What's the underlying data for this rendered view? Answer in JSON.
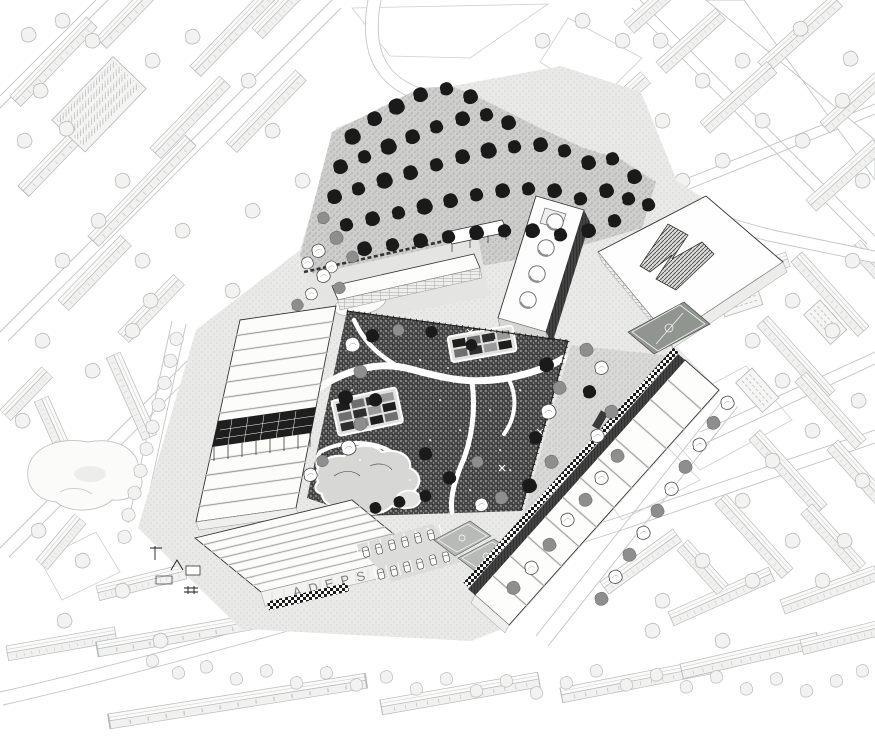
{
  "meta": {
    "title": "Black-and-white axonometric masterplan illustration",
    "description": "Bird's-eye axonometric drawing of an urban block: dark central park with winding paths framed by long white workshop buildings, a tree grove, a perforated slab, sports facilities and light-gray city fabric all around."
  },
  "colors": {
    "paper": "#ffffff",
    "ink": "#1a1a1a",
    "context_line": "#b7babc",
    "context_fill": "#f2f2f1",
    "park_fill": "#474747",
    "ground_light": "#e9e9e8",
    "ground_mid": "#cbcbca",
    "tree_dark": "#1a1a1a",
    "tree_gray": "#8e8e8e",
    "pitch_fill": "#90958f",
    "court_fill": "#b7bab7",
    "sign": "#7d7d7d"
  },
  "site": {
    "sign_text": "ADEPS"
  },
  "scene": {
    "slab_circles": [
      [
        528,
        300
      ],
      [
        537,
        274
      ],
      [
        546,
        248
      ],
      [
        555,
        222
      ]
    ],
    "beds": [
      {
        "x": 336,
        "y": 404,
        "rot": -12,
        "rows": 3,
        "cols": 4
      },
      {
        "x": 452,
        "y": 340,
        "rot": -10,
        "rows": 2,
        "cols": 4
      }
    ],
    "trees": {
      "grove_dark": [
        [
          352,
          138,
          1.1
        ],
        [
          374,
          120,
          1.0
        ],
        [
          396,
          108,
          1.1
        ],
        [
          420,
          96,
          1.0
        ],
        [
          446,
          90,
          0.9
        ],
        [
          470,
          98,
          1.0
        ],
        [
          340,
          168,
          1.0
        ],
        [
          364,
          158,
          0.9
        ],
        [
          388,
          148,
          1.1
        ],
        [
          412,
          138,
          1.0
        ],
        [
          436,
          128,
          0.9
        ],
        [
          462,
          120,
          1.0
        ],
        [
          486,
          116,
          0.9
        ],
        [
          508,
          124,
          1.0
        ],
        [
          334,
          198,
          1.0
        ],
        [
          358,
          190,
          0.9
        ],
        [
          384,
          182,
          1.1
        ],
        [
          410,
          174,
          1.0
        ],
        [
          436,
          166,
          0.9
        ],
        [
          462,
          158,
          1.0
        ],
        [
          488,
          152,
          1.1
        ],
        [
          514,
          148,
          0.9
        ],
        [
          540,
          146,
          1.0
        ],
        [
          564,
          152,
          0.9
        ],
        [
          588,
          164,
          1.0
        ],
        [
          346,
          226,
          0.9
        ],
        [
          372,
          220,
          1.0
        ],
        [
          398,
          214,
          0.9
        ],
        [
          424,
          208,
          1.1
        ],
        [
          450,
          202,
          1.0
        ],
        [
          476,
          196,
          0.9
        ],
        [
          502,
          192,
          1.0
        ],
        [
          528,
          190,
          0.9
        ],
        [
          554,
          192,
          1.0
        ],
        [
          580,
          200,
          0.9
        ],
        [
          606,
          192,
          1.0
        ],
        [
          628,
          200,
          0.9
        ],
        [
          364,
          250,
          1.0
        ],
        [
          392,
          246,
          0.9
        ],
        [
          420,
          242,
          1.0
        ],
        [
          448,
          238,
          0.9
        ],
        [
          476,
          234,
          1.0
        ],
        [
          504,
          232,
          0.9
        ],
        [
          532,
          232,
          1.0
        ],
        [
          560,
          236,
          0.9
        ],
        [
          588,
          232,
          1.0
        ],
        [
          614,
          222,
          0.9
        ],
        [
          612,
          160,
          0.9
        ],
        [
          634,
          178,
          1.0
        ],
        [
          648,
          206,
          0.9
        ]
      ],
      "grove_gray": [
        [
          336,
          239,
          0.9
        ],
        [
          323,
          219,
          0.8
        ],
        [
          352,
          258,
          0.8
        ]
      ],
      "grove_light": [
        [
          318,
          252,
          0.9
        ],
        [
          307,
          264,
          0.8
        ],
        [
          331,
          268,
          0.8
        ]
      ],
      "park": [
        [
          352,
          346,
          "w",
          1.0
        ],
        [
          360,
          373,
          "g",
          0.9
        ],
        [
          345,
          399,
          "d",
          1.0
        ],
        [
          360,
          425,
          "g",
          0.9
        ],
        [
          348,
          449,
          "w",
          1.0
        ],
        [
          375,
          401,
          "d",
          0.9
        ],
        [
          322,
          462,
          "g",
          0.8
        ],
        [
          310,
          476,
          "w",
          0.9
        ],
        [
          372,
          337,
          "d",
          0.9
        ],
        [
          398,
          331,
          "g",
          0.8
        ],
        [
          546,
          366,
          "d",
          1.0
        ],
        [
          559,
          389,
          "g",
          0.9
        ],
        [
          548,
          413,
          "w",
          1.0
        ],
        [
          535,
          439,
          "d",
          0.9
        ],
        [
          551,
          463,
          "g",
          0.9
        ],
        [
          529,
          487,
          "d",
          1.0
        ],
        [
          501,
          499,
          "g",
          0.9
        ],
        [
          481,
          506,
          "w",
          0.9
        ],
        [
          431,
          333,
          "d",
          0.8
        ],
        [
          471,
          346,
          "d",
          0.8
        ],
        [
          425,
          455,
          "d",
          0.9
        ],
        [
          477,
          463,
          "g",
          0.8
        ],
        [
          449,
          479,
          "d",
          0.9
        ],
        [
          375,
          509,
          "d",
          0.8
        ],
        [
          399,
          503,
          "d",
          0.8
        ],
        [
          425,
          497,
          "d",
          0.8
        ]
      ],
      "ne_strip": [
        [
          586,
          351,
          "g",
          0.9
        ],
        [
          601,
          369,
          "w",
          0.9
        ],
        [
          589,
          393,
          "d",
          0.9
        ],
        [
          611,
          413,
          "g",
          0.9
        ],
        [
          597,
          437,
          "w",
          0.9
        ],
        [
          617,
          457,
          "g",
          0.9
        ],
        [
          601,
          479,
          "w",
          0.9
        ],
        [
          585,
          501,
          "g",
          0.9
        ],
        [
          567,
          521,
          "w",
          0.9
        ],
        [
          549,
          546,
          "g",
          0.9
        ],
        [
          531,
          569,
          "w",
          0.9
        ],
        [
          513,
          589,
          "g",
          0.9
        ]
      ],
      "street_right": [
        [
          727,
          404,
          "w",
          0.9
        ],
        [
          713,
          424,
          "g",
          0.9
        ],
        [
          699,
          446,
          "w",
          0.9
        ],
        [
          685,
          468,
          "g",
          0.9
        ],
        [
          671,
          490,
          "w",
          0.9
        ],
        [
          657,
          512,
          "g",
          0.9
        ],
        [
          643,
          534,
          "w",
          0.9
        ],
        [
          629,
          556,
          "g",
          0.9
        ],
        [
          615,
          578,
          "w",
          0.9
        ],
        [
          601,
          600,
          "g",
          0.9
        ]
      ],
      "west_street": [
        [
          176,
          340
        ],
        [
          170,
          362
        ],
        [
          164,
          384
        ],
        [
          158,
          406
        ],
        [
          152,
          428
        ],
        [
          146,
          450
        ],
        [
          140,
          472
        ],
        [
          134,
          494
        ],
        [
          128,
          516
        ],
        [
          124,
          538
        ]
      ],
      "nw_cluster": [
        [
          323,
          277,
          "w",
          0.9
        ],
        [
          339,
          289,
          "g",
          0.8
        ],
        [
          311,
          295,
          "w",
          0.8
        ],
        [
          297,
          306,
          "g",
          0.8
        ]
      ],
      "context": [
        [
          28,
          36
        ],
        [
          62,
          22
        ],
        [
          92,
          42
        ],
        [
          40,
          92
        ],
        [
          24,
          142
        ],
        [
          66,
          130
        ],
        [
          152,
          62
        ],
        [
          192,
          38
        ],
        [
          248,
          82
        ],
        [
          272,
          132
        ],
        [
          122,
          182
        ],
        [
          98,
          222
        ],
        [
          62,
          262
        ],
        [
          142,
          262
        ],
        [
          182,
          232
        ],
        [
          252,
          212
        ],
        [
          302,
          182
        ],
        [
          232,
          292
        ],
        [
          132,
          332
        ],
        [
          92,
          372
        ],
        [
          42,
          342
        ],
        [
          22,
          422
        ],
        [
          38,
          532
        ],
        [
          82,
          562
        ],
        [
          150,
          302
        ],
        [
          660,
          42
        ],
        [
          702,
          82
        ],
        [
          742,
          62
        ],
        [
          662,
          122
        ],
        [
          622,
          42
        ],
        [
          582,
          22
        ],
        [
          542,
          42
        ],
        [
          842,
          102
        ],
        [
          862,
          182
        ],
        [
          802,
          142
        ],
        [
          762,
          122
        ],
        [
          722,
          162
        ],
        [
          682,
          182
        ],
        [
          642,
          222
        ],
        [
          850,
          60
        ],
        [
          800,
          30
        ],
        [
          832,
          332
        ],
        [
          852,
          262
        ],
        [
          792,
          302
        ],
        [
          752,
          342
        ],
        [
          722,
          302
        ],
        [
          782,
          382
        ],
        [
          812,
          432
        ],
        [
          772,
          462
        ],
        [
          742,
          502
        ],
        [
          792,
          542
        ],
        [
          822,
          582
        ],
        [
          752,
          582
        ],
        [
          702,
          562
        ],
        [
          662,
          602
        ],
        [
          862,
          482
        ],
        [
          858,
          402
        ],
        [
          844,
          542
        ],
        [
          64,
          622
        ],
        [
          122,
          592
        ],
        [
          160,
          642
        ],
        [
          722,
          642
        ],
        [
          652,
          632
        ]
      ],
      "garden_row": [
        [
          152,
          662
        ],
        [
          178,
          674
        ],
        [
          206,
          668
        ],
        [
          236,
          680
        ],
        [
          266,
          672
        ],
        [
          296,
          684
        ],
        [
          326,
          674
        ],
        [
          356,
          686
        ],
        [
          386,
          678
        ],
        [
          416,
          690
        ],
        [
          446,
          680
        ],
        [
          476,
          692
        ],
        [
          506,
          682
        ],
        [
          536,
          694
        ],
        [
          566,
          684
        ],
        [
          596,
          672
        ],
        [
          626,
          686
        ],
        [
          656,
          676
        ],
        [
          686,
          688
        ],
        [
          716,
          678
        ],
        [
          746,
          690
        ],
        [
          776,
          680
        ],
        [
          806,
          692
        ],
        [
          836,
          682
        ],
        [
          862,
          672
        ]
      ]
    },
    "cars": [
      [
        366,
        552,
        75
      ],
      [
        379,
        549,
        75
      ],
      [
        392,
        545,
        75
      ],
      [
        405,
        542,
        75
      ],
      [
        418,
        538,
        75
      ],
      [
        431,
        535,
        75
      ],
      [
        381,
        574,
        75
      ],
      [
        394,
        571,
        75
      ],
      [
        407,
        567,
        75
      ],
      [
        420,
        564,
        75
      ],
      [
        433,
        560,
        75
      ],
      [
        446,
        557,
        75
      ]
    ],
    "context_rows": [
      [
        18,
        186,
        -46,
        1.5
      ],
      [
        88,
        236,
        -46,
        1.4
      ],
      [
        10,
        96,
        -46,
        1.1
      ],
      [
        96,
        38,
        -46,
        1.3
      ],
      [
        190,
        66,
        -46,
        1.1
      ],
      [
        226,
        142,
        -46,
        1.0
      ],
      [
        150,
        148,
        -46,
        1.0
      ],
      [
        252,
        28,
        -46,
        0.8
      ],
      [
        58,
        300,
        -46,
        0.9
      ],
      [
        118,
        332,
        -46,
        0.8
      ],
      [
        0,
        410,
        -46,
        0.6
      ],
      [
        120,
        352,
        66,
        0.9
      ],
      [
        48,
        396,
        66,
        0.7
      ],
      [
        36,
        560,
        -50,
        0.6
      ],
      [
        96,
        586,
        -14,
        0.9
      ],
      [
        6,
        646,
        -10,
        1.1
      ],
      [
        96,
        642,
        -10,
        2.4
      ],
      [
        108,
        714,
        -9,
        2.6
      ],
      [
        380,
        700,
        -10,
        1.6
      ],
      [
        560,
        688,
        -11,
        1.6
      ],
      [
        680,
        664,
        -13,
        1.4
      ],
      [
        800,
        640,
        -14,
        1.0
      ],
      [
        600,
        582,
        -36,
        0.9
      ],
      [
        668,
        612,
        -24,
        1.1
      ],
      [
        780,
        600,
        -20,
        1.0
      ],
      [
        758,
        62,
        -42,
        1.0
      ],
      [
        820,
        122,
        -42,
        1.0
      ],
      [
        700,
        122,
        -42,
        0.9
      ],
      [
        656,
        62,
        -42,
        0.8
      ],
      [
        624,
        22,
        -42,
        0.7
      ],
      [
        806,
        200,
        -42,
        0.9
      ],
      [
        860,
        240,
        48,
        0.6
      ],
      [
        802,
        252,
        48,
        1.0
      ],
      [
        768,
        316,
        48,
        1.0
      ],
      [
        806,
        372,
        48,
        0.9
      ],
      [
        760,
        430,
        48,
        1.0
      ],
      [
        726,
        494,
        48,
        1.0
      ],
      [
        838,
        440,
        48,
        0.8
      ],
      [
        812,
        504,
        48,
        0.8
      ],
      [
        688,
        540,
        48,
        0.6
      ],
      [
        636,
        244,
        -18,
        0.8
      ],
      [
        700,
        280,
        -18,
        0.9
      ],
      [
        596,
        112,
        -42,
        0.6
      ]
    ],
    "apt_blocks": [
      [
        648,
        252,
        -18
      ],
      [
        718,
        296,
        -18
      ],
      [
        820,
        300,
        48
      ],
      [
        752,
        368,
        48
      ]
    ],
    "sparkles": [
      [
        420,
        360
      ],
      [
        448,
        368
      ],
      [
        400,
        420
      ],
      [
        430,
        440
      ],
      [
        460,
        430
      ],
      [
        490,
        410
      ],
      [
        360,
        460
      ],
      [
        390,
        470
      ],
      [
        500,
        450
      ],
      [
        520,
        390
      ],
      [
        480,
        360
      ],
      [
        440,
        400
      ],
      [
        410,
        480
      ],
      [
        470,
        490
      ],
      [
        510,
        470
      ],
      [
        530,
        440
      ],
      [
        370,
        430
      ],
      [
        352,
        390
      ],
      [
        450,
        350
      ],
      [
        495,
        340
      ]
    ],
    "crosses": [
      [
        502,
        468
      ],
      [
        540,
        432
      ],
      [
        470,
        332
      ]
    ]
  }
}
